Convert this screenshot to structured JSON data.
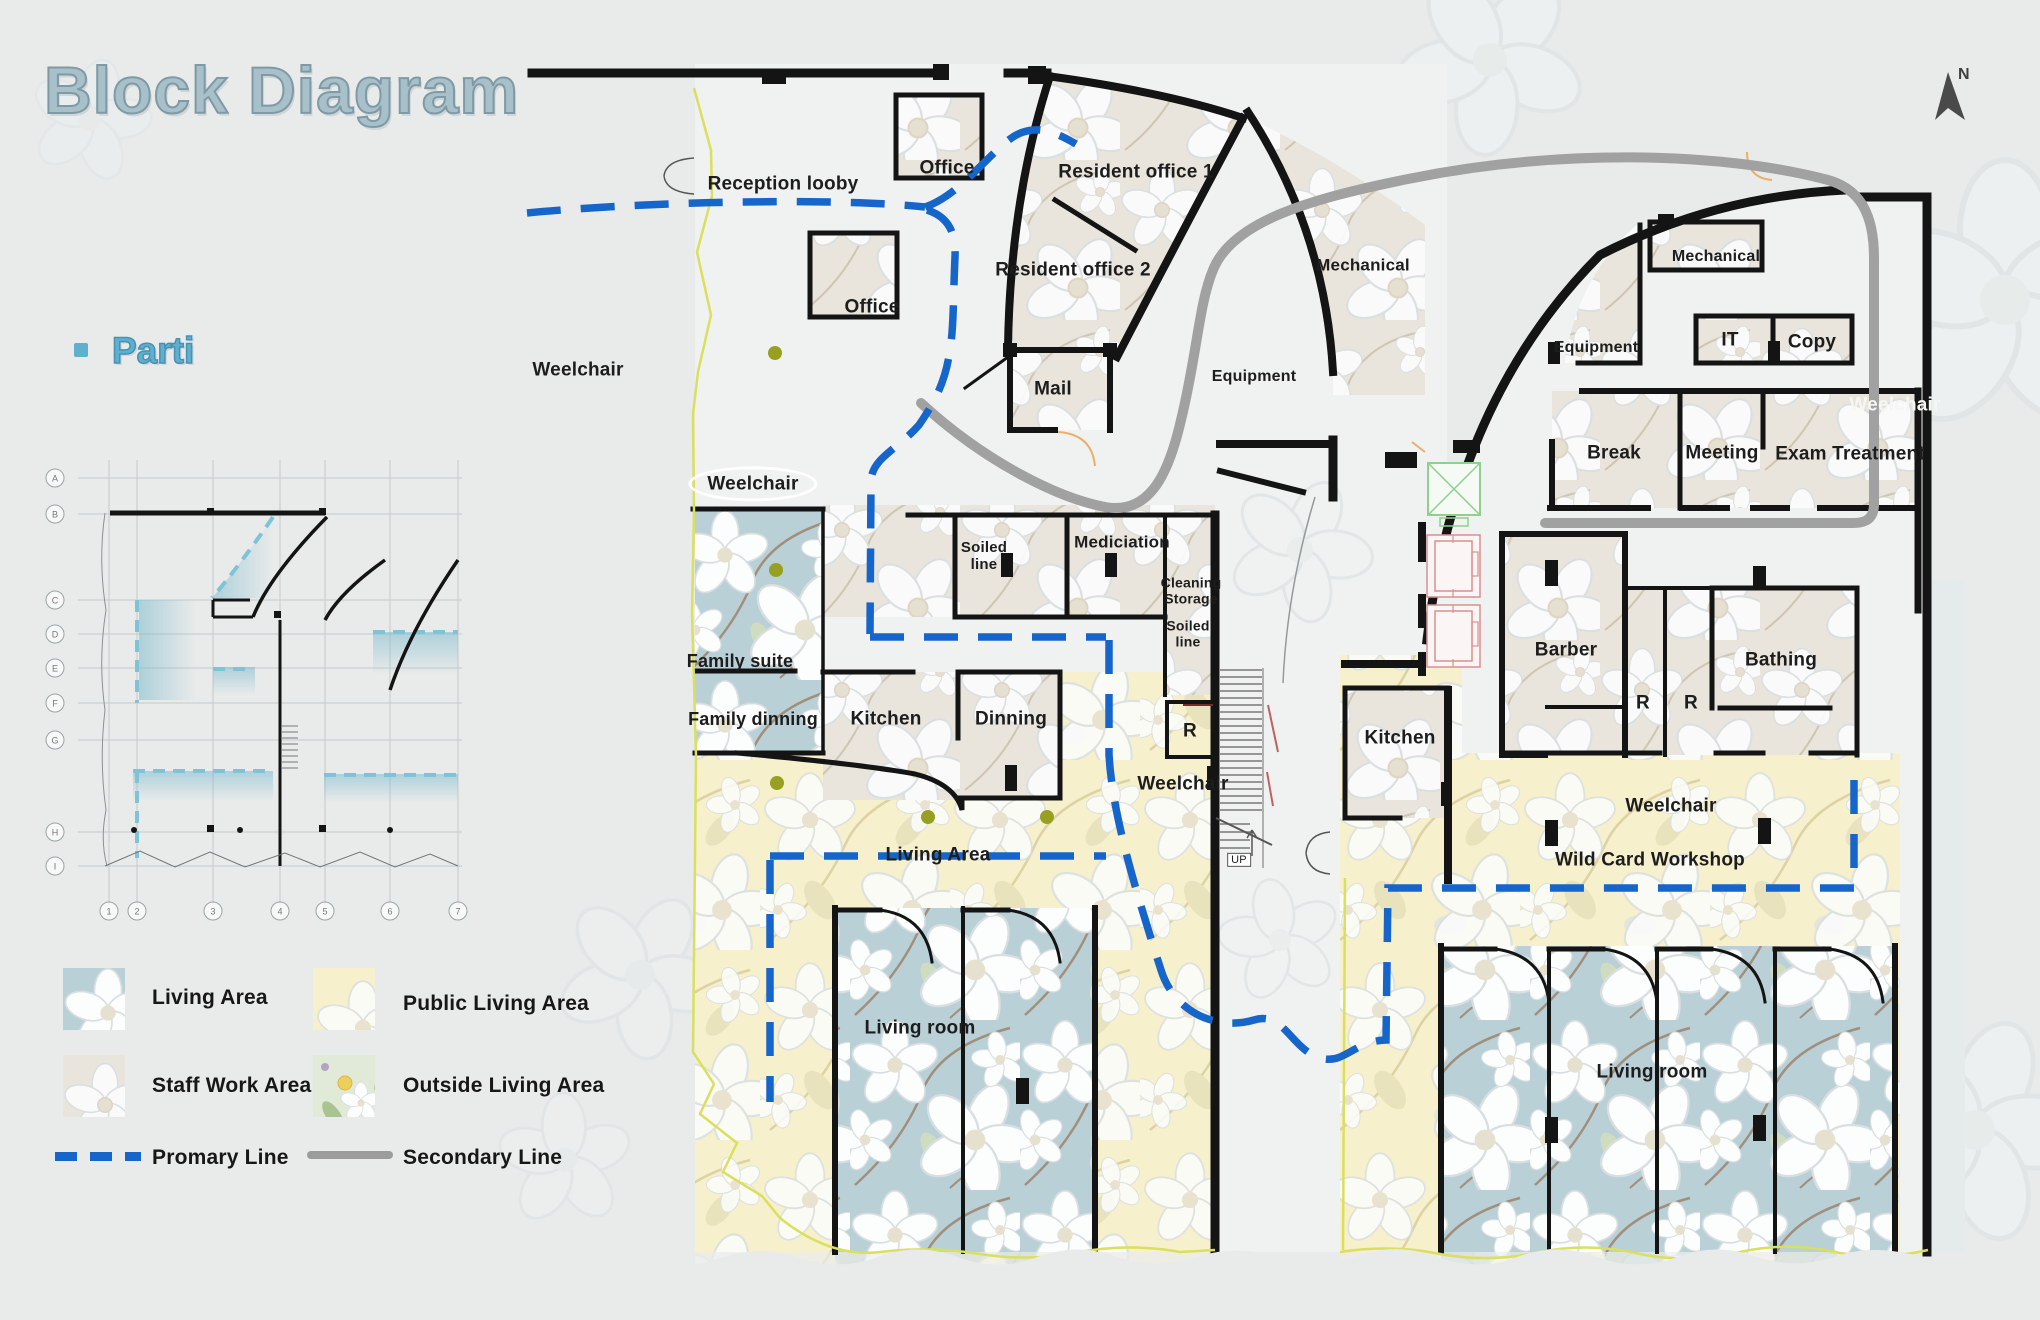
{
  "title": "Block Diagram",
  "north": {
    "label": "N"
  },
  "parti": {
    "heading": "Parti",
    "row_markers": [
      {
        "label": "A",
        "x": 55,
        "y": 478
      },
      {
        "label": "B",
        "x": 55,
        "y": 514
      },
      {
        "label": "C",
        "x": 55,
        "y": 600
      },
      {
        "label": "D",
        "x": 55,
        "y": 634
      },
      {
        "label": "E",
        "x": 55,
        "y": 668
      },
      {
        "label": "F",
        "x": 55,
        "y": 703
      },
      {
        "label": "G",
        "x": 55,
        "y": 740
      },
      {
        "label": "H",
        "x": 55,
        "y": 832
      },
      {
        "label": "I",
        "x": 55,
        "y": 866
      }
    ],
    "col_markers": [
      {
        "label": "1",
        "x": 109,
        "y": 911
      },
      {
        "label": "2",
        "x": 137,
        "y": 911
      },
      {
        "label": "3",
        "x": 213,
        "y": 911
      },
      {
        "label": "4",
        "x": 280,
        "y": 911
      },
      {
        "label": "5",
        "x": 325,
        "y": 911
      },
      {
        "label": "6",
        "x": 390,
        "y": 911
      },
      {
        "label": "7",
        "x": 458,
        "y": 911
      }
    ]
  },
  "legend": {
    "areas": [
      {
        "label": "Living Area",
        "pattern": "blue"
      },
      {
        "label": "Public Living Area",
        "pattern": "yellow"
      },
      {
        "label": "Staff Work Area",
        "pattern": "beige"
      },
      {
        "label": "Outside Living Area",
        "pattern": "green"
      }
    ],
    "lines": [
      {
        "label": "Promary Line",
        "style": "dashed",
        "color": "#1565cb"
      },
      {
        "label": "Secondary Line",
        "style": "solid",
        "color": "#9c9c9c"
      }
    ]
  },
  "plan": {
    "labels": [
      {
        "text": "Reception looby",
        "x": 783,
        "y": 184
      },
      {
        "text": "Office",
        "x": 947,
        "y": 168
      },
      {
        "text": "Resident office 1",
        "x": 1136,
        "y": 172
      },
      {
        "text": "Resident office 2",
        "x": 1073,
        "y": 270
      },
      {
        "text": "Office",
        "x": 872,
        "y": 307
      },
      {
        "text": "Mail",
        "x": 1053,
        "y": 389
      },
      {
        "text": "Mechanical",
        "x": 1363,
        "y": 265,
        "size": 17
      },
      {
        "text": "Equipment",
        "x": 1254,
        "y": 377,
        "size": 16
      },
      {
        "text": "Equipment",
        "x": 1596,
        "y": 348,
        "size": 16
      },
      {
        "text": "Mechanical",
        "x": 1716,
        "y": 257,
        "size": 16
      },
      {
        "text": "IT",
        "x": 1730,
        "y": 340
      },
      {
        "text": "Copy",
        "x": 1812,
        "y": 342
      },
      {
        "text": "Break",
        "x": 1614,
        "y": 453
      },
      {
        "text": "Meeting",
        "x": 1722,
        "y": 453
      },
      {
        "text": "Exam Treatment",
        "x": 1850,
        "y": 454
      },
      {
        "text": "Weelchair",
        "x": 578,
        "y": 370
      },
      {
        "text": "Weelchair",
        "x": 753,
        "y": 484,
        "style": "oval"
      },
      {
        "text": "Weelchair",
        "x": 1895,
        "y": 405,
        "style": "white"
      },
      {
        "text": "Soiled\nline",
        "x": 984,
        "y": 557,
        "size": 15
      },
      {
        "text": "Mediciation",
        "x": 1122,
        "y": 542,
        "size": 17
      },
      {
        "text": "Cleaning\nStorage",
        "x": 1191,
        "y": 591,
        "size": 14
      },
      {
        "text": "Soiled\nline",
        "x": 1188,
        "y": 634,
        "size": 14
      },
      {
        "text": "Family suite",
        "x": 740,
        "y": 661,
        "size": 18
      },
      {
        "text": "Family dinning",
        "x": 753,
        "y": 719,
        "size": 18
      },
      {
        "text": "Kitchen",
        "x": 886,
        "y": 719
      },
      {
        "text": "Dinning",
        "x": 1011,
        "y": 719
      },
      {
        "text": "R",
        "x": 1190,
        "y": 731
      },
      {
        "text": "Weelchair",
        "x": 1183,
        "y": 784
      },
      {
        "text": "UP",
        "x": 1239,
        "y": 860,
        "style": "upbox",
        "size": 11
      },
      {
        "text": "Living Area",
        "x": 938,
        "y": 855
      },
      {
        "text": "Living room",
        "x": 920,
        "y": 1028
      },
      {
        "text": "Barber",
        "x": 1566,
        "y": 650
      },
      {
        "text": "R",
        "x": 1643,
        "y": 703
      },
      {
        "text": "R",
        "x": 1691,
        "y": 703
      },
      {
        "text": "Bathing",
        "x": 1781,
        "y": 660
      },
      {
        "text": "Kitchen",
        "x": 1400,
        "y": 738
      },
      {
        "text": "Weelchair",
        "x": 1671,
        "y": 806
      },
      {
        "text": "Wild Card Workshop",
        "x": 1650,
        "y": 860
      },
      {
        "text": "Living room",
        "x": 1652,
        "y": 1072
      }
    ]
  },
  "colors": {
    "primary_line": "#1565cb",
    "secondary_line": "#9c9c9c",
    "title": "#a8c0ca",
    "parti_heading": "#5fb0cf",
    "walls": "#141414",
    "living_area_blue": "#b9d0d7",
    "public_living_yellow": "#f7f0cd",
    "staff_beige": "#e9e5dc",
    "outside_green": "#e0ead6",
    "boundary_yellow": "#dadf5e",
    "accent_dot": "#97a021"
  }
}
